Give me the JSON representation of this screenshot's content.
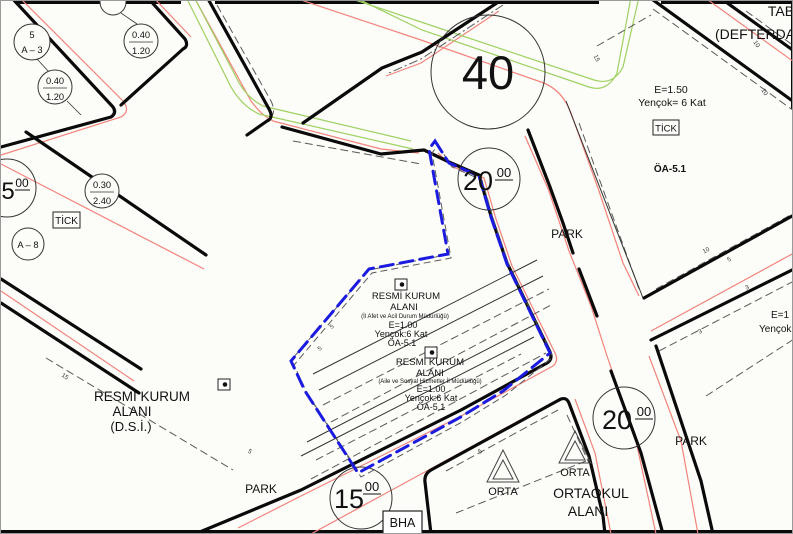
{
  "colors": {
    "background": "#fcfcf8",
    "line_black": "#0a0a0a",
    "road_edge_red": "#f2837b",
    "median_green": "#9ed162",
    "boundary_blue": "#1b1be0",
    "setback_gray": "#5a5a5a"
  },
  "road_width_labels": {
    "w40": {
      "value": "40"
    },
    "w20_top": {
      "value": "20",
      "decimals": "00"
    },
    "w20_right": {
      "value": "20",
      "decimals": "00"
    },
    "w15": {
      "value": "15",
      "decimals": "00"
    },
    "w5_left": {
      "value": "5",
      "decimals": "00"
    }
  },
  "parcel_circles": {
    "c_a3": {
      "top": "5",
      "bottom": "A – 3"
    },
    "c_ratio1": {
      "top": "0.40",
      "bottom": "1.20"
    },
    "c_ratio2": {
      "top": "0.40",
      "bottom": "1.20"
    },
    "c_ratio3": {
      "top": "0.30",
      "bottom": "2.40"
    },
    "c_a8": {
      "label": "A – 8"
    }
  },
  "boxed_labels": {
    "tick_left": "TİCK",
    "tick_right": "TİCK",
    "bha": "BHA"
  },
  "areas": {
    "dsi": {
      "line1": "RESMİ KURUM",
      "line2": "ALANI",
      "line3": "(D.S.İ.)"
    },
    "parcel_afad": {
      "line1": "RESMİ KURUM",
      "line2": "ALANI",
      "line3": "(İl Afet ve Acil Durum Müdürlüğü)",
      "line4": "E=1.00",
      "line5": "Yençok:6 Kat",
      "line6": "ÖA-5.1"
    },
    "parcel_aile": {
      "line1": "RESMİ KURUM",
      "line2": "ALANI",
      "line3": "(Aile ve Sosyal Hizmetler İl Müdürlüğü)",
      "line4": "E=1.00",
      "line5": "Yençok:6 Kat",
      "line6": "ÖA-5.1"
    },
    "commercial_block": {
      "line1": "E=1.50",
      "line2": "Yençok= 6 Kat",
      "line3": "ÖA-5.1"
    },
    "park_upper": "PARK",
    "park_lower": "PARK",
    "park_right": "PARK",
    "school": {
      "line1": "ORTAOKUL",
      "line2": "ALANI",
      "symbol_label": "ORTA"
    },
    "corner_block": {
      "line1": "TAB",
      "line2": "(DEFTERDA"
    },
    "right_edge_block": {
      "line1": "E=1",
      "line2": "Yençok"
    }
  },
  "dimensions": [
    "15",
    "15",
    "10",
    "10",
    "10",
    "5",
    "3",
    "3",
    "5",
    "5",
    "5",
    "5"
  ]
}
